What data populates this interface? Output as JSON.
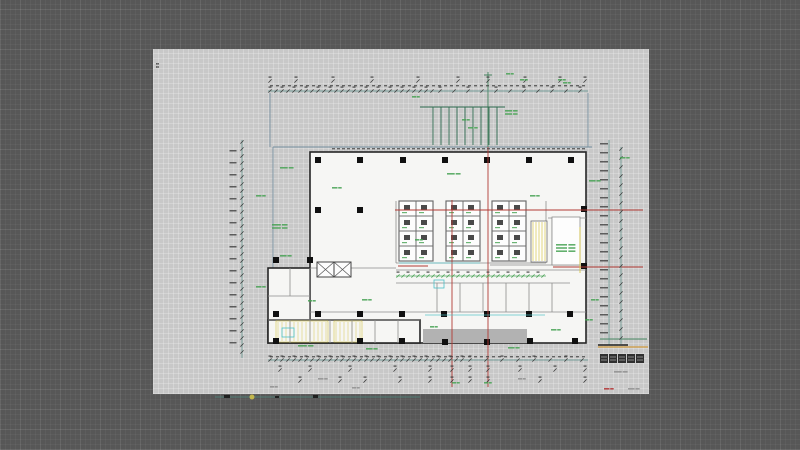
{
  "app": {
    "background_color": "#575757"
  },
  "sheet": {
    "x": 153,
    "y": 49,
    "width": 496,
    "height": 345,
    "color": "#c8c8c8"
  },
  "palette": {
    "wall": "#262626",
    "partition": "#8c8c8c",
    "interior": "#f6f6f4",
    "dim_green": "#3f7f5a",
    "dim_teal": "#4e8a80",
    "tick_dark": "#3a3a3a",
    "grid_red": "#b23a34",
    "boundary_blue": "#76909f",
    "annotation_green": "#47a253",
    "yellow": "#d6c54a",
    "cyan": "#4cc0c6",
    "canopy": "#b2b2b2",
    "orange": "#d09a3e",
    "micro_dark": "#404040",
    "micro_gray": "#8f8f8f",
    "title_dark": "#232323",
    "red_text": "#b23030",
    "shaft_wall": "#6e6e6e",
    "machine": "#4a4a4a",
    "column": "#101010"
  },
  "drawing": {
    "rooms": [
      {
        "x": 310,
        "y": 152,
        "w": 276,
        "h": 191
      },
      {
        "x": 268,
        "y": 268,
        "w": 42,
        "h": 75
      },
      {
        "x": 268,
        "y": 320,
        "w": 152,
        "h": 23
      }
    ],
    "canopy": {
      "x": 423,
      "y": 329,
      "w": 104,
      "h": 14
    },
    "yellow_hatches": [
      {
        "x": 276,
        "y": 321,
        "w": 52,
        "h": 21
      },
      {
        "x": 334,
        "y": 321,
        "w": 28,
        "h": 21
      }
    ],
    "blue_segments": [
      [
        273,
        147,
        273,
        343
      ],
      [
        273,
        147,
        592,
        147
      ],
      [
        270,
        93,
        270,
        147
      ],
      [
        588,
        93,
        588,
        147
      ]
    ],
    "partitions": [
      [
        396,
        270,
        586,
        270
      ],
      [
        396,
        283,
        570,
        283
      ],
      [
        310,
        312,
        586,
        312
      ],
      [
        437,
        283,
        437,
        312
      ],
      [
        460,
        283,
        460,
        312
      ],
      [
        483,
        283,
        483,
        312
      ],
      [
        506,
        283,
        506,
        312
      ],
      [
        529,
        283,
        529,
        312
      ],
      [
        552,
        283,
        552,
        312
      ],
      [
        268,
        296,
        310,
        296
      ],
      [
        290,
        268,
        290,
        296
      ],
      [
        268,
        320,
        420,
        320
      ],
      [
        290,
        320,
        290,
        343
      ],
      [
        310,
        268,
        310,
        343
      ],
      [
        330,
        320,
        330,
        343
      ],
      [
        352,
        320,
        352,
        343
      ],
      [
        375,
        320,
        375,
        343
      ],
      [
        398,
        320,
        398,
        343
      ],
      [
        548,
        218,
        586,
        218
      ],
      [
        552,
        218,
        552,
        265
      ],
      [
        490,
        265,
        586,
        265
      ],
      [
        396,
        201,
        396,
        263
      ],
      [
        546,
        201,
        546,
        263
      ],
      [
        396,
        263,
        546,
        263
      ],
      [
        310,
        268,
        396,
        268
      ]
    ],
    "elevator_banks": [
      {
        "x": 399,
        "y": 201,
        "cols": 2,
        "rows": 4,
        "cw": 17,
        "ch": 15
      },
      {
        "x": 446,
        "y": 201,
        "cols": 2,
        "rows": 4,
        "cw": 17,
        "ch": 15
      },
      {
        "x": 492,
        "y": 201,
        "cols": 2,
        "rows": 4,
        "cw": 17,
        "ch": 15
      }
    ],
    "elevator_pair": {
      "x": 317,
      "y": 262,
      "cells": 2,
      "cw": 17,
      "ch": 15
    },
    "stair": {
      "x": 531,
      "y": 221,
      "w": 16,
      "h": 41,
      "tread_sp": 3
    },
    "toilet": {
      "x": 552,
      "y": 217,
      "w": 28,
      "h": 48
    },
    "columns": [
      [
        318,
        160
      ],
      [
        360,
        160
      ],
      [
        403,
        160
      ],
      [
        445,
        160
      ],
      [
        487,
        160
      ],
      [
        529,
        160
      ],
      [
        571,
        160
      ],
      [
        318,
        210
      ],
      [
        360,
        210
      ],
      [
        584,
        209
      ],
      [
        276,
        260
      ],
      [
        310,
        260
      ],
      [
        584,
        266
      ],
      [
        276,
        314
      ],
      [
        318,
        314
      ],
      [
        360,
        314
      ],
      [
        402,
        314
      ],
      [
        444,
        314
      ],
      [
        487,
        314
      ],
      [
        529,
        314
      ],
      [
        570,
        314
      ],
      [
        276,
        341
      ],
      [
        360,
        341
      ],
      [
        402,
        341
      ],
      [
        445,
        342
      ],
      [
        487,
        342
      ],
      [
        530,
        341
      ],
      [
        575,
        341
      ]
    ],
    "red_lines": [
      [
        452,
        200,
        452,
        387
      ],
      [
        488,
        147,
        488,
        387
      ],
      [
        395,
        210,
        643,
        210
      ],
      [
        553,
        267,
        643,
        267
      ],
      [
        398,
        266,
        428,
        266
      ]
    ],
    "green_segments": [
      [
        488,
        72,
        488,
        147
      ],
      [
        484,
        75,
        492,
        75
      ],
      [
        600,
        339,
        647,
        339
      ]
    ],
    "railing": {
      "x1": 420,
      "x2": 505,
      "y": 107,
      "drop": 145,
      "bar_from": 433,
      "bar_to": 497,
      "sp": 8
    },
    "cyan_segments": [
      [
        425,
        315,
        545,
        315
      ],
      [
        399,
        263,
        480,
        263
      ]
    ],
    "yellow_segments": [
      [
        580,
        227,
        580,
        273
      ]
    ],
    "cyan_rects": [
      [
        434,
        280,
        10,
        8
      ],
      [
        282,
        328,
        12,
        9
      ]
    ],
    "dim_h": [
      {
        "y": 91,
        "x1": 268,
        "x2": 588,
        "line": 1,
        "ticks": [
          {
            "from": 270,
            "to": 432,
            "sp": 6
          },
          {
            "from": 440,
            "to": 586,
            "sp": 14
          }
        ]
      },
      {
        "y": 81,
        "x1": 268,
        "x2": 588,
        "line": 0,
        "marks": [
          270,
          296,
          333,
          372,
          418,
          458,
          488,
          525,
          560,
          585
        ]
      },
      {
        "y": 360,
        "x1": 268,
        "x2": 588,
        "line": 1,
        "ticks": [
          {
            "from": 270,
            "to": 462,
            "sp": 6
          },
          {
            "from": 470,
            "to": 586,
            "sp": 16
          }
        ]
      },
      {
        "y": 370,
        "x1": 280,
        "x2": 585,
        "line": 0,
        "marks": [
          280,
          310,
          350,
          395,
          430,
          452,
          470,
          488,
          520,
          555,
          585
        ]
      },
      {
        "y": 381,
        "x1": 300,
        "x2": 585,
        "line": 0,
        "marks": [
          300,
          340,
          365,
          400,
          430,
          452,
          470,
          488,
          540,
          585
        ]
      },
      {
        "y": 276,
        "x1": 396,
        "x2": 546,
        "line": 1,
        "ticks": [
          {
            "from": 398,
            "to": 545,
            "sp": 5
          }
        ],
        "bright": 1
      }
    ],
    "dim_v": [
      {
        "x": 242,
        "y1": 140,
        "y2": 358,
        "line": 1,
        "sp": 7
      },
      {
        "x": 621,
        "y1": 147,
        "y2": 344,
        "line": 1,
        "sp": 9
      },
      {
        "x": 609,
        "y1": 140,
        "y2": 345,
        "line": 1,
        "sp": 0
      }
    ],
    "micro_cols": [
      {
        "x": 233,
        "y1": 150,
        "y2": 352,
        "sp": 12,
        "w": 7
      },
      {
        "x": 604,
        "y1": 143,
        "y2": 340,
        "sp": 9,
        "w": 8
      }
    ],
    "micro_rows": [
      {
        "y": 85,
        "x1": 270,
        "x2": 586,
        "sp": 6,
        "w": 3
      },
      {
        "y": 148,
        "x1": 332,
        "x2": 584,
        "sp": 5,
        "w": 3
      },
      {
        "y": 356,
        "x1": 270,
        "x2": 584,
        "sp": 6,
        "w": 3
      }
    ],
    "labels_green": [
      [
        280,
        167,
        1,
        14
      ],
      [
        256,
        195,
        1,
        10
      ],
      [
        272,
        224,
        2,
        16
      ],
      [
        280,
        255,
        1,
        12
      ],
      [
        256,
        286,
        1,
        10
      ],
      [
        332,
        187,
        1,
        10
      ],
      [
        447,
        173,
        1,
        14
      ],
      [
        530,
        195,
        1,
        10
      ],
      [
        589,
        180,
        1,
        12
      ],
      [
        620,
        157,
        1,
        10
      ],
      [
        505,
        110,
        2,
        13
      ],
      [
        462,
        119,
        1,
        8
      ],
      [
        468,
        127,
        1,
        10
      ],
      [
        520,
        79,
        1,
        8
      ],
      [
        558,
        79,
        1,
        8
      ],
      [
        506,
        73,
        1,
        8
      ],
      [
        412,
        96,
        1,
        8
      ],
      [
        415,
        239,
        1,
        8
      ],
      [
        362,
        299,
        1,
        10
      ],
      [
        308,
        300,
        1,
        8
      ],
      [
        298,
        345,
        1,
        16
      ],
      [
        366,
        348,
        1,
        12
      ],
      [
        508,
        347,
        1,
        12
      ],
      [
        551,
        329,
        1,
        10
      ],
      [
        591,
        299,
        1,
        8
      ],
      [
        585,
        319,
        1,
        8
      ],
      [
        430,
        326,
        1,
        8
      ],
      [
        452,
        382,
        1,
        8
      ],
      [
        484,
        382,
        1,
        8
      ],
      [
        563,
        82,
        1,
        8
      ],
      [
        556,
        244,
        3,
        20
      ]
    ],
    "labels_gray": [
      [
        318,
        378,
        1,
        10
      ],
      [
        518,
        378,
        1,
        8
      ],
      [
        270,
        386,
        1,
        8
      ],
      [
        352,
        387,
        1,
        8
      ],
      [
        614,
        371,
        1,
        14
      ],
      [
        628,
        388,
        1,
        12
      ]
    ],
    "labels_dark": [
      [
        156,
        63,
        2,
        3
      ]
    ],
    "labels_red": [
      [
        604,
        388,
        1,
        10
      ]
    ],
    "title_block": {
      "glyphs": [
        [
          600,
          354
        ],
        [
          609,
          354
        ],
        [
          618,
          354
        ],
        [
          627,
          354
        ],
        [
          636,
          354
        ]
      ],
      "gw": 8,
      "gh": 9,
      "bar_dark": [
        598,
        345,
        628,
        345
      ],
      "bar_orange": [
        598,
        347,
        648,
        347
      ]
    },
    "scale_bar": {
      "line": [
        215,
        397,
        420,
        397
      ],
      "blobs": [
        [
          224,
          395,
          6,
          3
        ],
        [
          275,
          396,
          4,
          2
        ],
        [
          313,
          395,
          5,
          3
        ]
      ],
      "dot": {
        "x": 252,
        "y": 397,
        "r": 2.5
      }
    }
  }
}
